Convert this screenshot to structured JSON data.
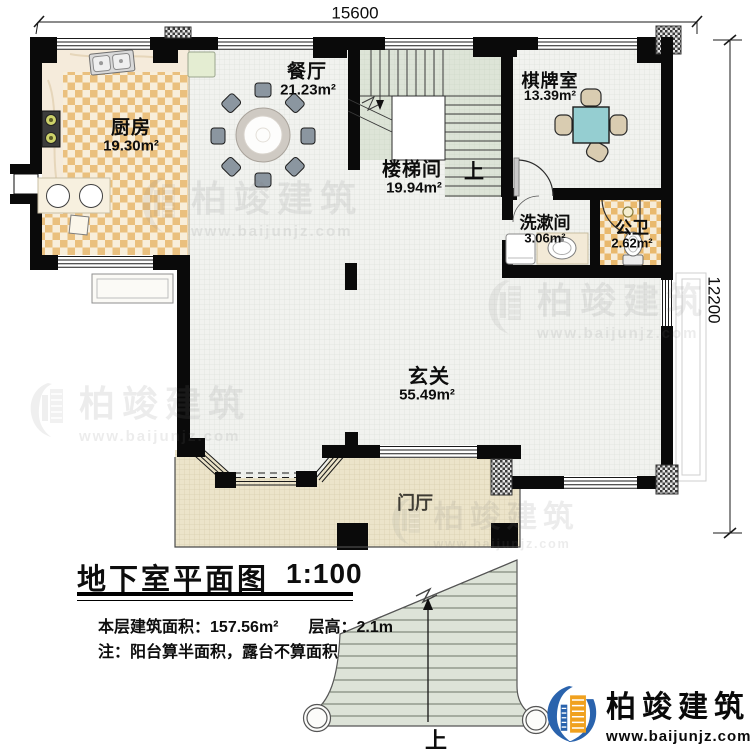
{
  "dimensions": {
    "top": "15600",
    "right": "12200"
  },
  "rooms": {
    "kitchen": {
      "name": "厨房",
      "area": "19.30m²"
    },
    "dining": {
      "name": "餐厅",
      "area": "21.23m²"
    },
    "stairwell": {
      "name": "楼梯间",
      "area": "19.94m²"
    },
    "chess_room": {
      "name": "棋牌室",
      "area": "13.39m²"
    },
    "washroom": {
      "name": "洗漱间",
      "area": "3.06m²"
    },
    "toilet": {
      "name": "公卫",
      "area": "2.62m²"
    },
    "hall": {
      "name": "玄关",
      "area": "55.49m²"
    },
    "foyer": {
      "name": "门厅"
    }
  },
  "stair_labels": {
    "interior_up": "上",
    "exterior_up": "上"
  },
  "title_block": {
    "title": "地下室平面图",
    "scale": "1:100",
    "floor_area_label": "本层建筑面积：",
    "floor_area_value": "157.56m²",
    "height_label": "层高：",
    "height_value": "2.1m",
    "note": "注：阳台算半面积，露台不算面积"
  },
  "branding": {
    "company": "柏竣建筑",
    "website": "www.baijunjz.com"
  },
  "watermark": {
    "company": "柏竣建筑",
    "website": "www.baijunjz.com"
  },
  "colors": {
    "logo_blue": "#2a63ad",
    "logo_orange": "#f0a11e",
    "wall": "#0a0a0a",
    "stair_green": "#dde4d7",
    "kitchen_checker": "#eac07e",
    "porch": "#ece4ca"
  }
}
